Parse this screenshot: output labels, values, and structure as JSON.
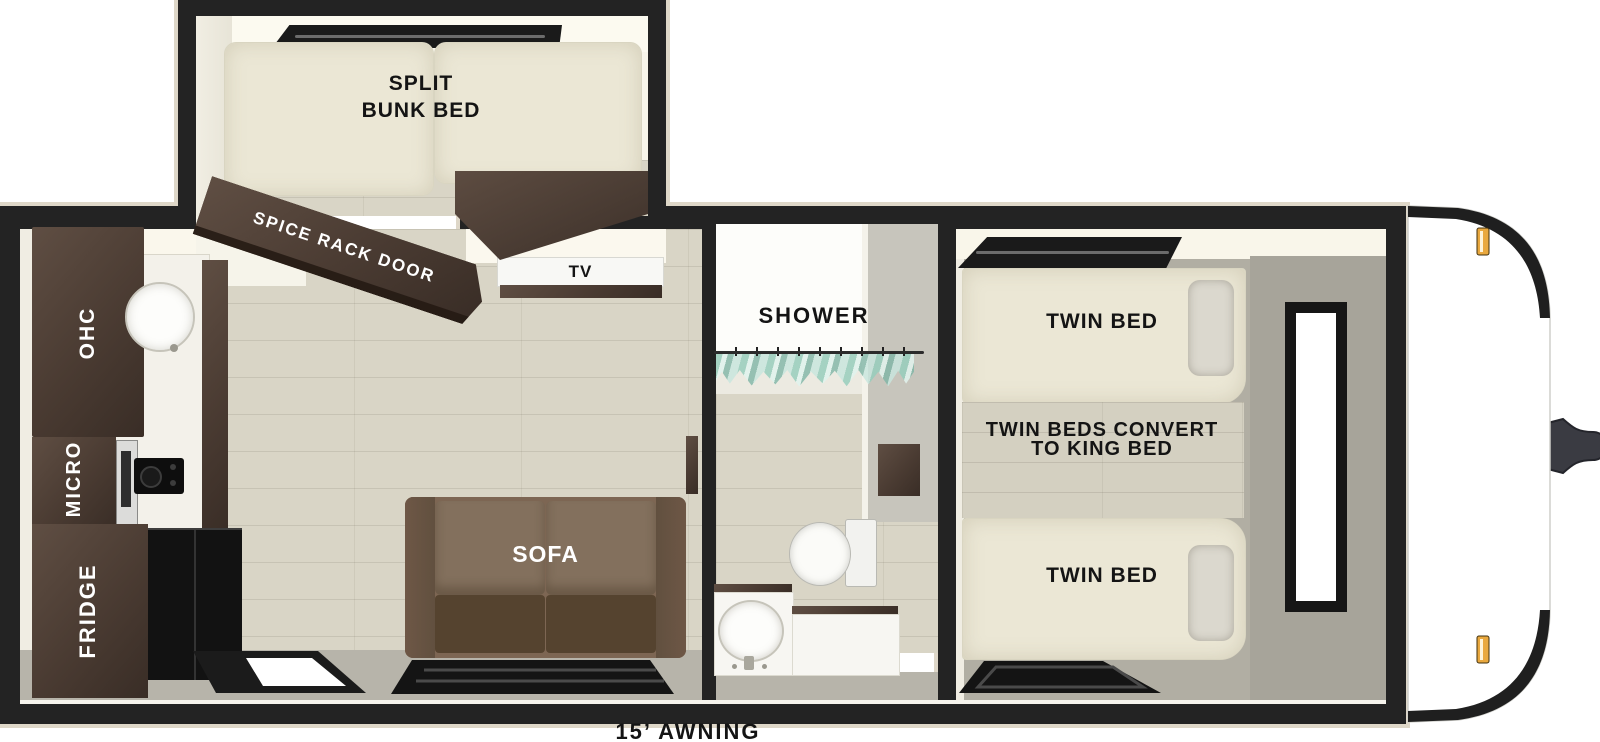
{
  "colors": {
    "wall": "#232323",
    "hull_outline": "#ded7c8",
    "wood_floor": "#d9d5c6",
    "ceiling_cream": "#faf7ec",
    "mattress": "#ebe7d5",
    "dark_wood": "#4a3b32",
    "sofa_brown": "#7d6653",
    "sofa_seat": "#55432f",
    "appliance_black": "#151515",
    "bedroom_floor": "#b1aea3",
    "bedroom_wall": "#a7a49a",
    "shower_curtain": "#a9d4c4",
    "marker_light": "#e9a83e",
    "hitch_gray": "#3a3b42"
  },
  "labels": {
    "bunk": {
      "line1": "SPLIT",
      "line2": "BUNK BED"
    },
    "spice_rack_door": "SPICE RACK DOOR",
    "tv": "TV",
    "kitchen": {
      "ohc": "OHC",
      "micro": "MICRO",
      "fridge": "FRIDGE"
    },
    "sofa": "SOFA",
    "shower": "SHOWER",
    "bedroom": {
      "twin_front": "TWIN BED",
      "convert1": "TWIN BEDS CONVERT",
      "convert2": "TO KING BED",
      "twin_rear": "TWIN BED"
    },
    "awning": "15’ AWNING"
  }
}
